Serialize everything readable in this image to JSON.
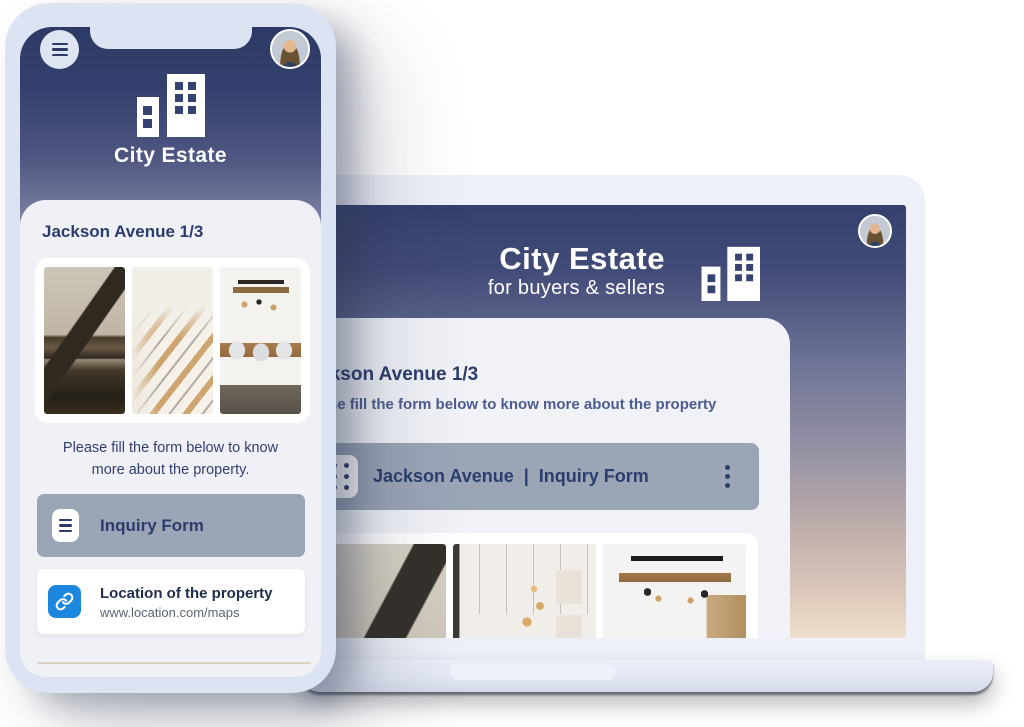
{
  "brand": {
    "name": "City Estate",
    "tagline": "for buyers & sellers",
    "logo_icon": "buildings-logo-icon"
  },
  "phone": {
    "menu_icon": "hamburger-menu-icon",
    "avatar_icon": "user-avatar-photo",
    "logo_label": "City Estate",
    "listing": {
      "title": "Jackson Avenue 1/3"
    },
    "helper": {
      "line1": "Please fill the form below to know",
      "line2": "more about the property."
    },
    "inquiry": {
      "label": "Inquiry Form",
      "icon": "form-lines-icon"
    },
    "location": {
      "icon": "link-icon",
      "title": "Location of the property",
      "url": "www.location.com/maps"
    },
    "gallery_photos": [
      "house-exterior-photo",
      "staircase-photo",
      "dining-kitchen-photo"
    ]
  },
  "laptop": {
    "avatar_icon": "user-avatar-photo",
    "logo_label": "City Estate",
    "tagline": "for buyers & sellers",
    "listing": {
      "title": "Jackson Avenue 1/3",
      "helper": "Please fill the form below to know more about the property"
    },
    "toolbar": {
      "left": "Jackson Avenue",
      "separator": "|",
      "right": "Inquiry Form",
      "drag_icon": "drag-handle-icon",
      "menu_icon": "kebab-menu-icon"
    },
    "gallery_photos": [
      "house-exterior-photo",
      "hallway-pendant-photo",
      "kitchen-beam-photo"
    ]
  },
  "colors": {
    "accent_blue": "#1d87e0",
    "navy_text": "#2d3c6b",
    "bar_gray": "#9aa5b6",
    "gradient_top_navy": "#35416d",
    "gradient_bottom_beige": "#eedecb",
    "phone_frame": "#dce4f4",
    "card_bg": "#f0f1f6"
  }
}
